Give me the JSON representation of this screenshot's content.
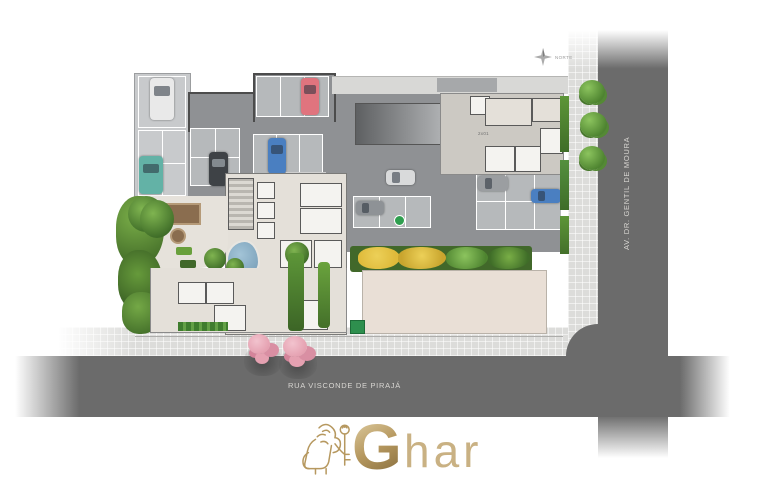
{
  "site_plan": {
    "north_label": "NORTE",
    "streets": {
      "vertical": "AV. DR. GENTIL DE MOURA",
      "horizontal": "RUA VISCONDE DE PIRAJÁ"
    },
    "stall_label": "2x01"
  },
  "logo": {
    "initial": "G",
    "rest": "har"
  },
  "colors": {
    "road": "#6b6b6b",
    "sidewalk": "#dcdcda",
    "garage": "#8f9194",
    "stall": "#b6b9bb",
    "annex": "#c8cacc",
    "beige": "#e4e0d9",
    "plaza": "#e9dfd6",
    "wall": "#4c4c4c",
    "white_room": "#f4f3f0",
    "green": "#69a03c",
    "green_dark": "#41682a",
    "green_bright": "#82b74e",
    "grass": "#a6c083",
    "yellow": "#dfba3a",
    "pink": "#e5a1b1",
    "pool": "#7ea6bf",
    "gold": "#b6985f",
    "gold_light": "#d8c496",
    "text_light": "#d8d6d2",
    "car_red": "#e0747e",
    "car_blue": "#4a7fc1",
    "car_teal": "#63b2a6"
  }
}
